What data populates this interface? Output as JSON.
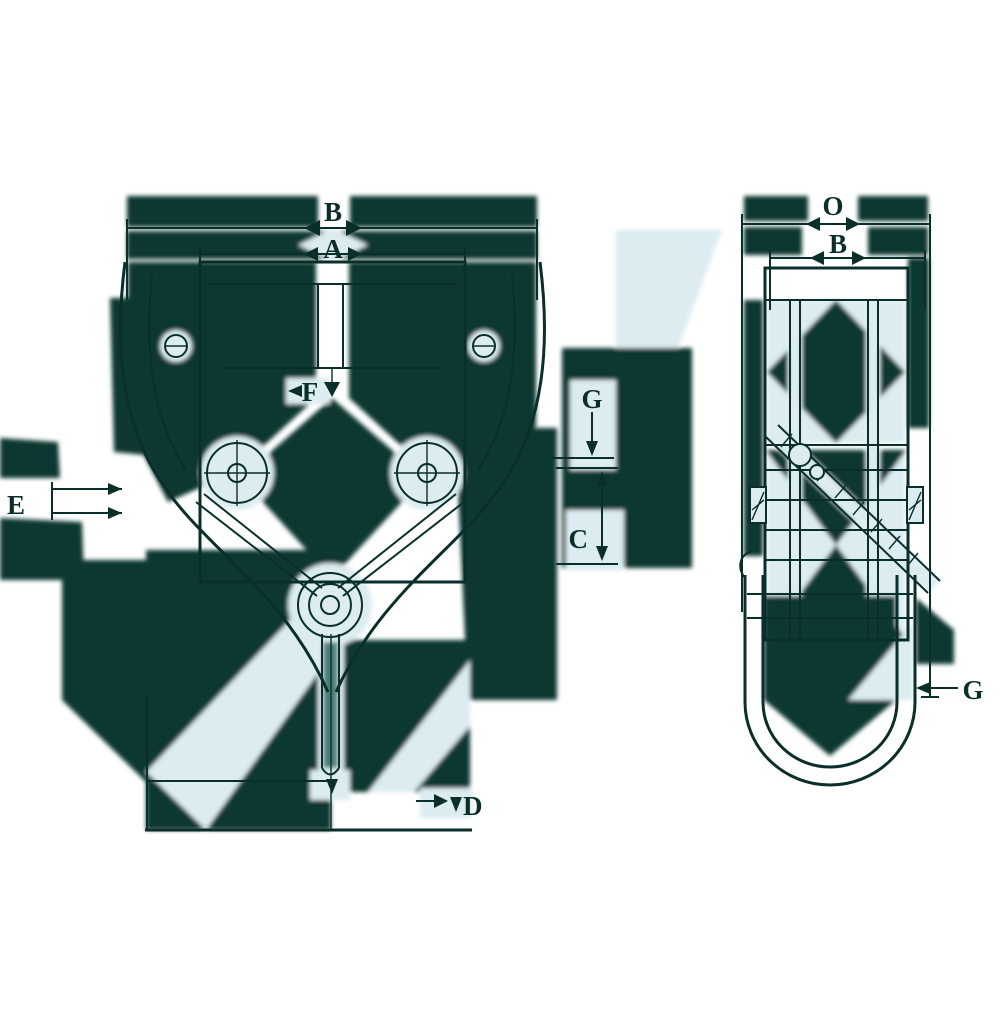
{
  "drawing_title": "clamp-dimension-drawing",
  "front_view": {
    "dim_top_outer": "B",
    "dim_top_inner": "A",
    "dim_left": "E",
    "dim_center": "F",
    "dim_right_upper": "G",
    "dim_right_lower": "C",
    "dim_bottom": "D"
  },
  "side_view": {
    "dim_top_outer": "O",
    "dim_top_inner": "B",
    "dim_bottom_right": "G"
  },
  "colors": {
    "ink": "#0a2f2b",
    "artifact_dark": "#0d3733",
    "artifact_pale": "#dcecf1",
    "slot_teal": "#2e6a64",
    "background": "#ffffff"
  }
}
